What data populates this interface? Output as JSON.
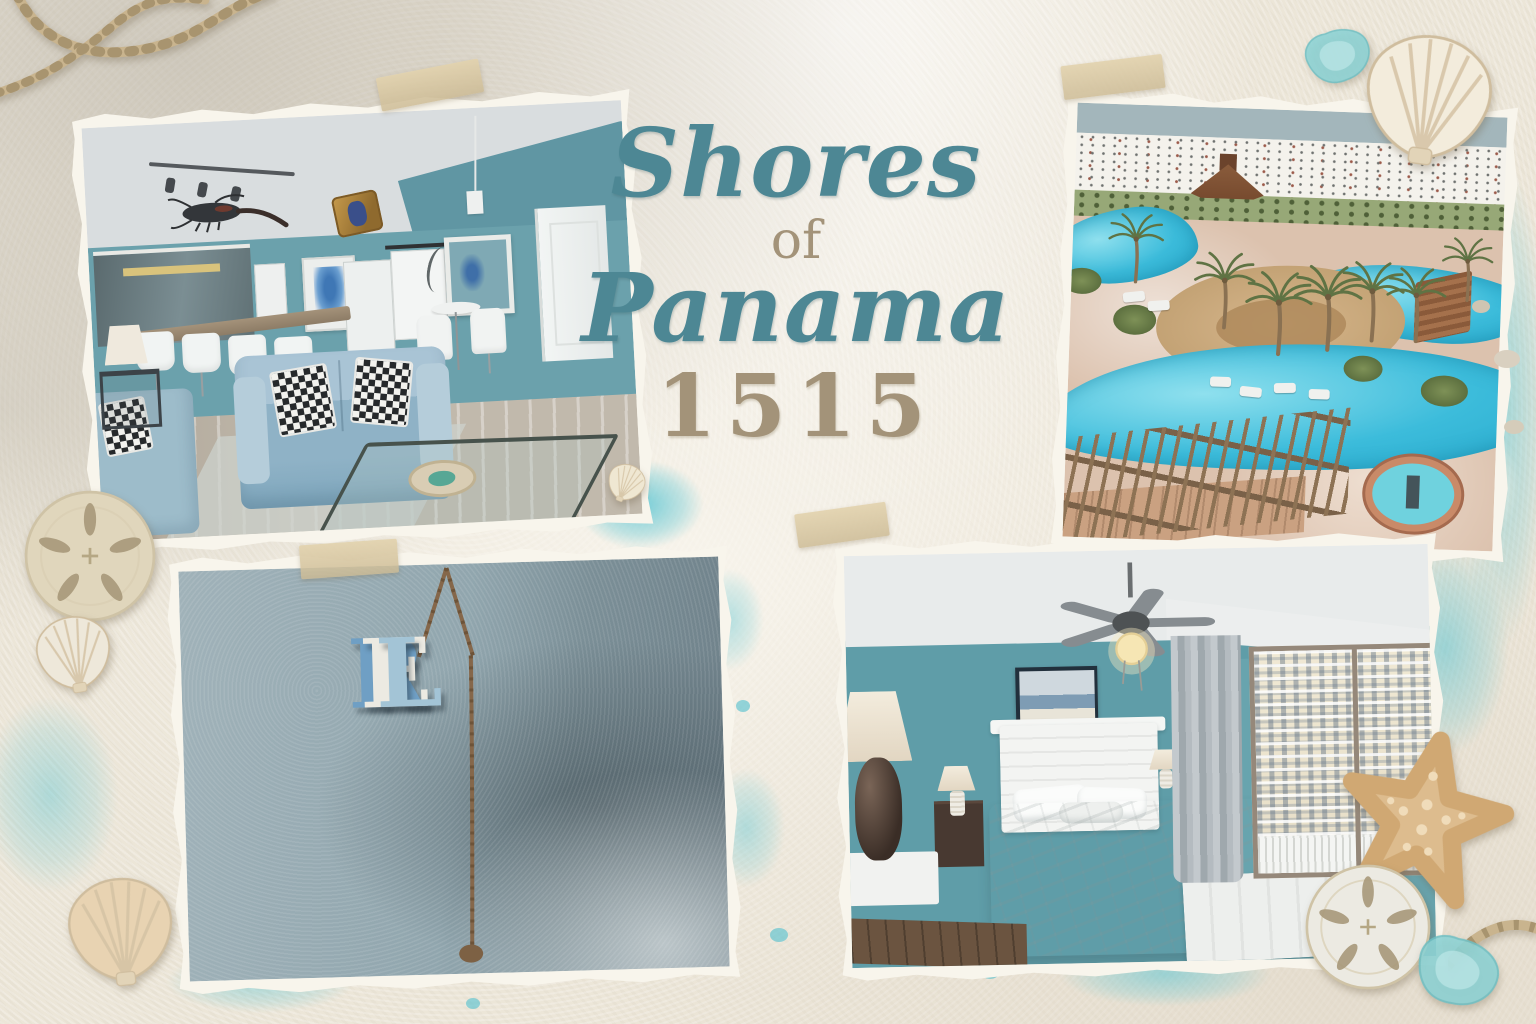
{
  "page": {
    "name": "Shores of Panama 1515 vacation rental photo collage"
  },
  "title": {
    "line1": "Shores",
    "line2": "of",
    "line3": "Panama",
    "line4": "1515"
  },
  "relax_sign": {
    "letters": [
      "R",
      "E",
      "L"
    ],
    "letter_colors": [
      "#6f9fc4",
      "#eceae2",
      "#a3c4d6"
    ]
  },
  "photos": {
    "living_room": {
      "label": "living room with bar and blue sofas"
    },
    "pool": {
      "label": "aerial view of resort lagoon pool, palms and beach"
    },
    "relax": {
      "label": "vertical letter sign hanging on teal wall"
    },
    "bedroom": {
      "label": "bedroom with white bed, ceiling fan and gulf-view window"
    }
  },
  "colors": {
    "title_teal": "#4d8794",
    "title_tan": "#a39379",
    "background_sand": "#ece6d8",
    "splatter_teal": "#5dc6d3",
    "photo_border": "#f8f5ec",
    "tape": "#d8c5a0"
  },
  "decorations": {
    "top_left": [
      "rope"
    ],
    "top_right": [
      "sea-glass",
      "scallop-shell"
    ],
    "left": [
      "sand-dollar",
      "scallop-shell"
    ],
    "bottom_left": [
      "scallop-shell"
    ],
    "center": [
      "tiny-shell"
    ],
    "right": [
      "starfish",
      "sand-dollar",
      "sea-glass",
      "rope",
      "pebbles"
    ]
  }
}
